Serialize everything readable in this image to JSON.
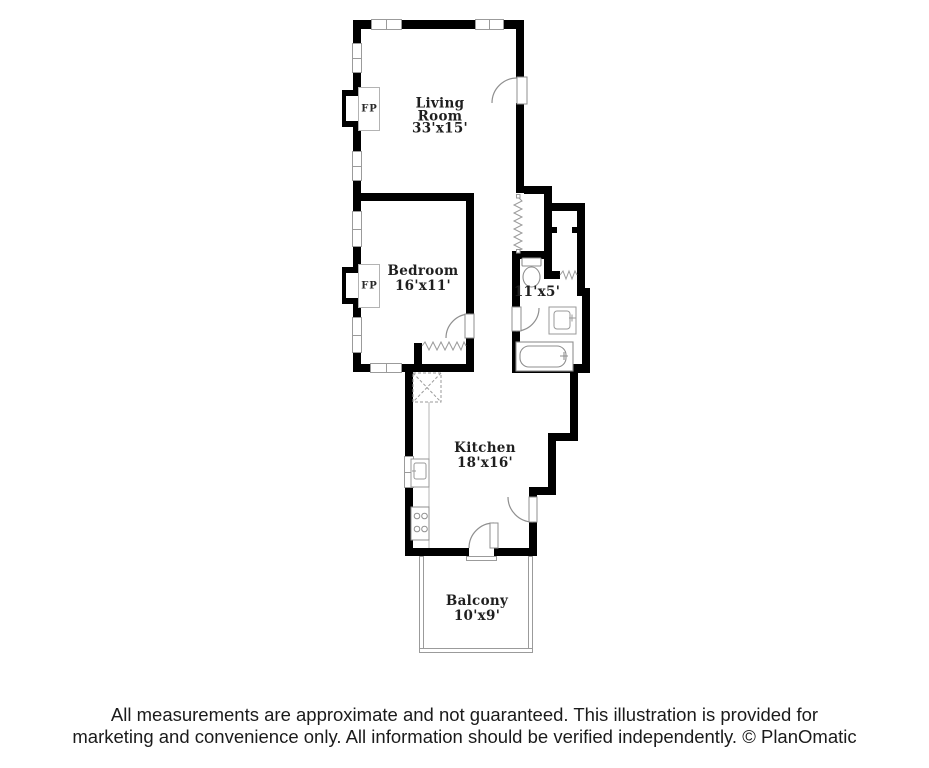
{
  "plan": {
    "living_room": {
      "line1": "Living",
      "line2": "Room",
      "dims": "33'x15'"
    },
    "bedroom": {
      "name": "Bedroom",
      "dims": "16'x11'"
    },
    "bathroom": {
      "dims": "11'x5'"
    },
    "kitchen": {
      "name": "Kitchen",
      "dims": "18'x16'"
    },
    "balcony": {
      "name": "Balcony",
      "dims": "10'x9'"
    },
    "fireplace_label": "FP"
  },
  "footer": {
    "line1": "All measurements are approximate and not guaranteed. This illustration is provided for",
    "line2": "marketing and convenience only. All information should be verified independently. © PlanOmatic"
  },
  "colors": {
    "wall": "#000000",
    "fixture_line": "#8f8f8f",
    "text": "#1f1f1f"
  }
}
